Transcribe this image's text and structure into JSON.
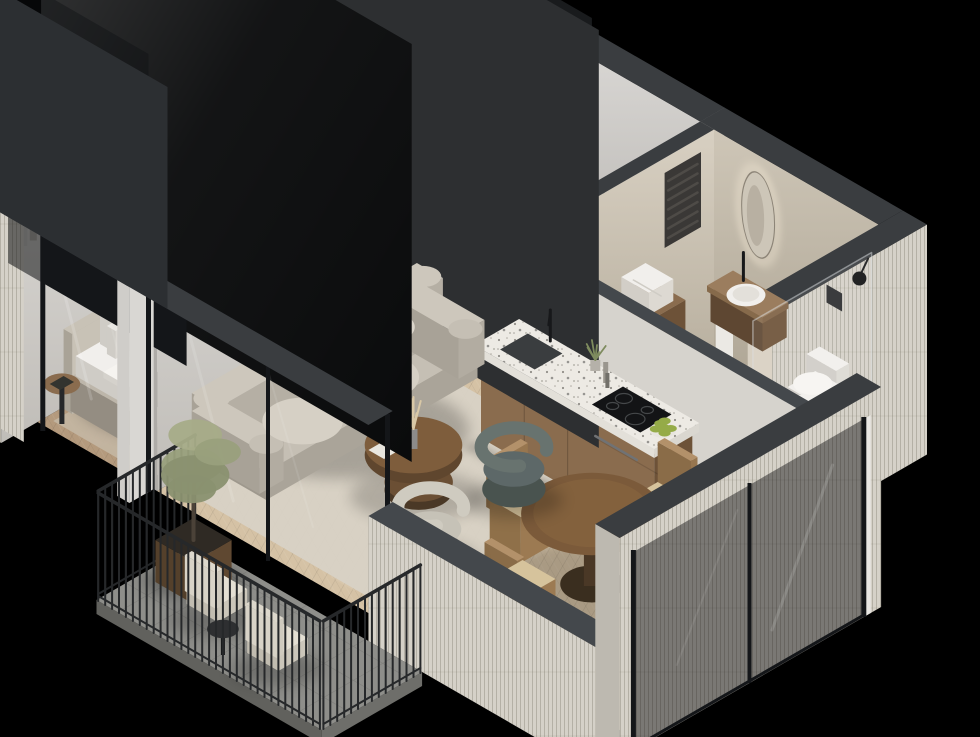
{
  "scene": {
    "type": "isometric-3d-apartment-floorplan-render",
    "background": "#000000",
    "view": "cutaway isometric from south-east, walls cut dark grey, exterior light brick"
  },
  "palette": {
    "bg": "#000000",
    "wallTop": "#3a3d40",
    "wallTopL": "#44484c",
    "wa1": "#e7e5e2",
    "wa2": "#c0bdb8",
    "wb1": "#dcdad7",
    "wb2": "#aeaba7",
    "ba1": "#d8d0c2",
    "ba2": "#b0a796",
    "bb1": "#cfc7b8",
    "bb2": "#a69d8c",
    "brick": "#d5d1c8",
    "brickShade": "#bdb9b0",
    "floorBed": "#b49a7d",
    "floorHall": "#9a826a",
    "floorLiving": "#d5c2a5",
    "floorBath": "#a7a39b",
    "balconyFloor": "#8e8e8a",
    "rugBed": "#c3b5a1",
    "rugLiving": "#d7d1c5",
    "wood": "#8a6c4e",
    "woodDark": "#6d5238",
    "woodSide": "#5e4732",
    "walnut": "#7b5a3a",
    "walnutDark": "#4a3826",
    "doorWood": "#7b5c41",
    "white": "#f1efec",
    "softWhite": "#e9e7e3",
    "dark": "#17181a",
    "metal": "#26282a",
    "throw": "#545955",
    "throwD": "#454a47",
    "headboard": "#c8c2b6",
    "headboardD": "#a9a397",
    "bedBase": "#bdb6aa",
    "bedBaseD": "#a19a8f",
    "bedBaseS": "#948d82",
    "mattD": "#dcd9d3",
    "mattS": "#cfccc6",
    "duvet": "#f6f4f0",
    "duvetD": "#e2dfd9",
    "duvetS": "#d5d2cc",
    "sofa": "#cdc7bc",
    "sofaSeat": "#c5bfb4",
    "sofaDark": "#aaa499",
    "cushion": "#d6d0c5",
    "teal": "#5d6868",
    "tealDark": "#49534f",
    "tealLight": "#68736f",
    "chairBeige": "#c6c2b7",
    "terrazzo": "#edeae4",
    "tvBlack": "#0a0b0c",
    "frameDark": "#141619",
    "apple": "#95ab48",
    "caneSeat": "#d6c39c",
    "chairWood": "#b3916a",
    "artBg": "#e8e1d2",
    "artInk": "#1e2025",
    "artOlive": "#6f746f",
    "pampas": "#d9c8a6",
    "olive1": "#99a07c",
    "olive2": "#8a9170",
    "olive3": "#a6ac88",
    "clothes": [
      "#c9c7c3",
      "#55585a",
      "#e4e2de",
      "#8e8c88",
      "#35373a",
      "#b4b0a9"
    ]
  },
  "rooms": [
    {
      "name": "bedroom",
      "furniture": [
        "double-bed",
        "fabric-headboard",
        "pillows",
        "white-duvet",
        "dark-throw",
        "open-wardrobe",
        "hanging-clothes",
        "folded-linens",
        "wall-art-pair",
        "pendant-lamp",
        "pendant-lamp",
        "pampas-side-table",
        "round-bedside-table",
        "area-rug",
        "picture-window"
      ]
    },
    {
      "name": "hallway",
      "furniture": [
        "entry-door",
        "white-lowboard",
        "hanging-clothes",
        "folded-towels",
        "bedroom-door"
      ]
    },
    {
      "name": "bathroom",
      "furniture": [
        "towel-radiator",
        "wood-cabinet",
        "folded-towels",
        "floating-vanity",
        "round-basin",
        "black-faucet",
        "backlit-pill-mirror",
        "wall-hung-toilet",
        "flush-plate",
        "wall-lamp",
        "shower-glass",
        "toilet-brush"
      ]
    },
    {
      "name": "kitchen",
      "furniture": [
        "island-counter",
        "terrazzo-worktop",
        "undermount-sink",
        "black-faucet",
        "induction-hob",
        "built-in-oven",
        "fruit-bowl",
        "plant",
        "bottles"
      ]
    },
    {
      "name": "dining",
      "furniture": [
        "round-walnut-table",
        "cane-chair",
        "cane-chair",
        "cane-chair",
        "cane-chair"
      ]
    },
    {
      "name": "living-room",
      "furniture": [
        "curved-sofa",
        "round-bolsters",
        "organic-coffee-table",
        "pampas-vase",
        "teal-armchair",
        "beige-armchair",
        "area-rug",
        "tv-screen",
        "glass-sliding-door",
        "corner-window"
      ]
    },
    {
      "name": "balcony",
      "furniture": [
        "metal-railing",
        "olive-tree",
        "wood-planter",
        "outdoor-chair",
        "outdoor-chair",
        "side-table"
      ]
    }
  ]
}
